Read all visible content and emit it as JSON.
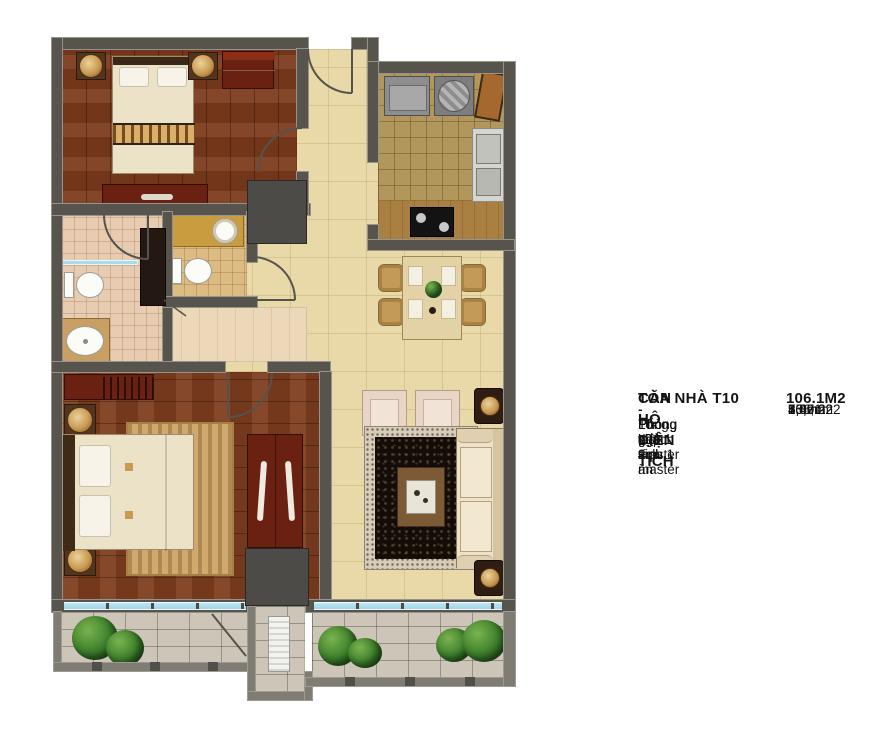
{
  "legend": {
    "building": "TÒA NHÀ T10",
    "subtitle": "CĂN HỘ DIỆN TÍCH",
    "subtitle_area": "106.1M2",
    "items": [
      {
        "label": "- Tổng diện tích",
        "value": "106,1m2"
      },
      {
        "label": "- Phòng khách + p. ăn",
        "value": "33,9m2"
      },
      {
        "label": "- Phòng bếp",
        "value": "8,0m2"
      },
      {
        "label": "- Phòng ngủ master",
        "value": "20,0m2"
      },
      {
        "label": "- Phòng ngủ 1",
        "value": "15,7m2"
      },
      {
        "label": "- Phòng vệ sinh master",
        "value": "7,0m2"
      },
      {
        "label": "- Phòng vệ sinh 1",
        "value": "4,8m2"
      },
      {
        "label": "- Lô gia 1",
        "value": "5,8m2"
      },
      {
        "label": "- Lô gia 2",
        "value": "5,4m2"
      }
    ]
  },
  "colors": {
    "wall": "#57544e",
    "wood_floor": "#7c3a1c",
    "common_floor": "#e9d9a8",
    "kitchen_tile": "#b2975c",
    "bath_tile": "#e8ccb1",
    "balcony_tile": "#ccc5b8",
    "window_glass": "#a8dcee",
    "furniture_red": "#6a2112",
    "accent_gold": "#d9b06a",
    "text": "#141414"
  }
}
